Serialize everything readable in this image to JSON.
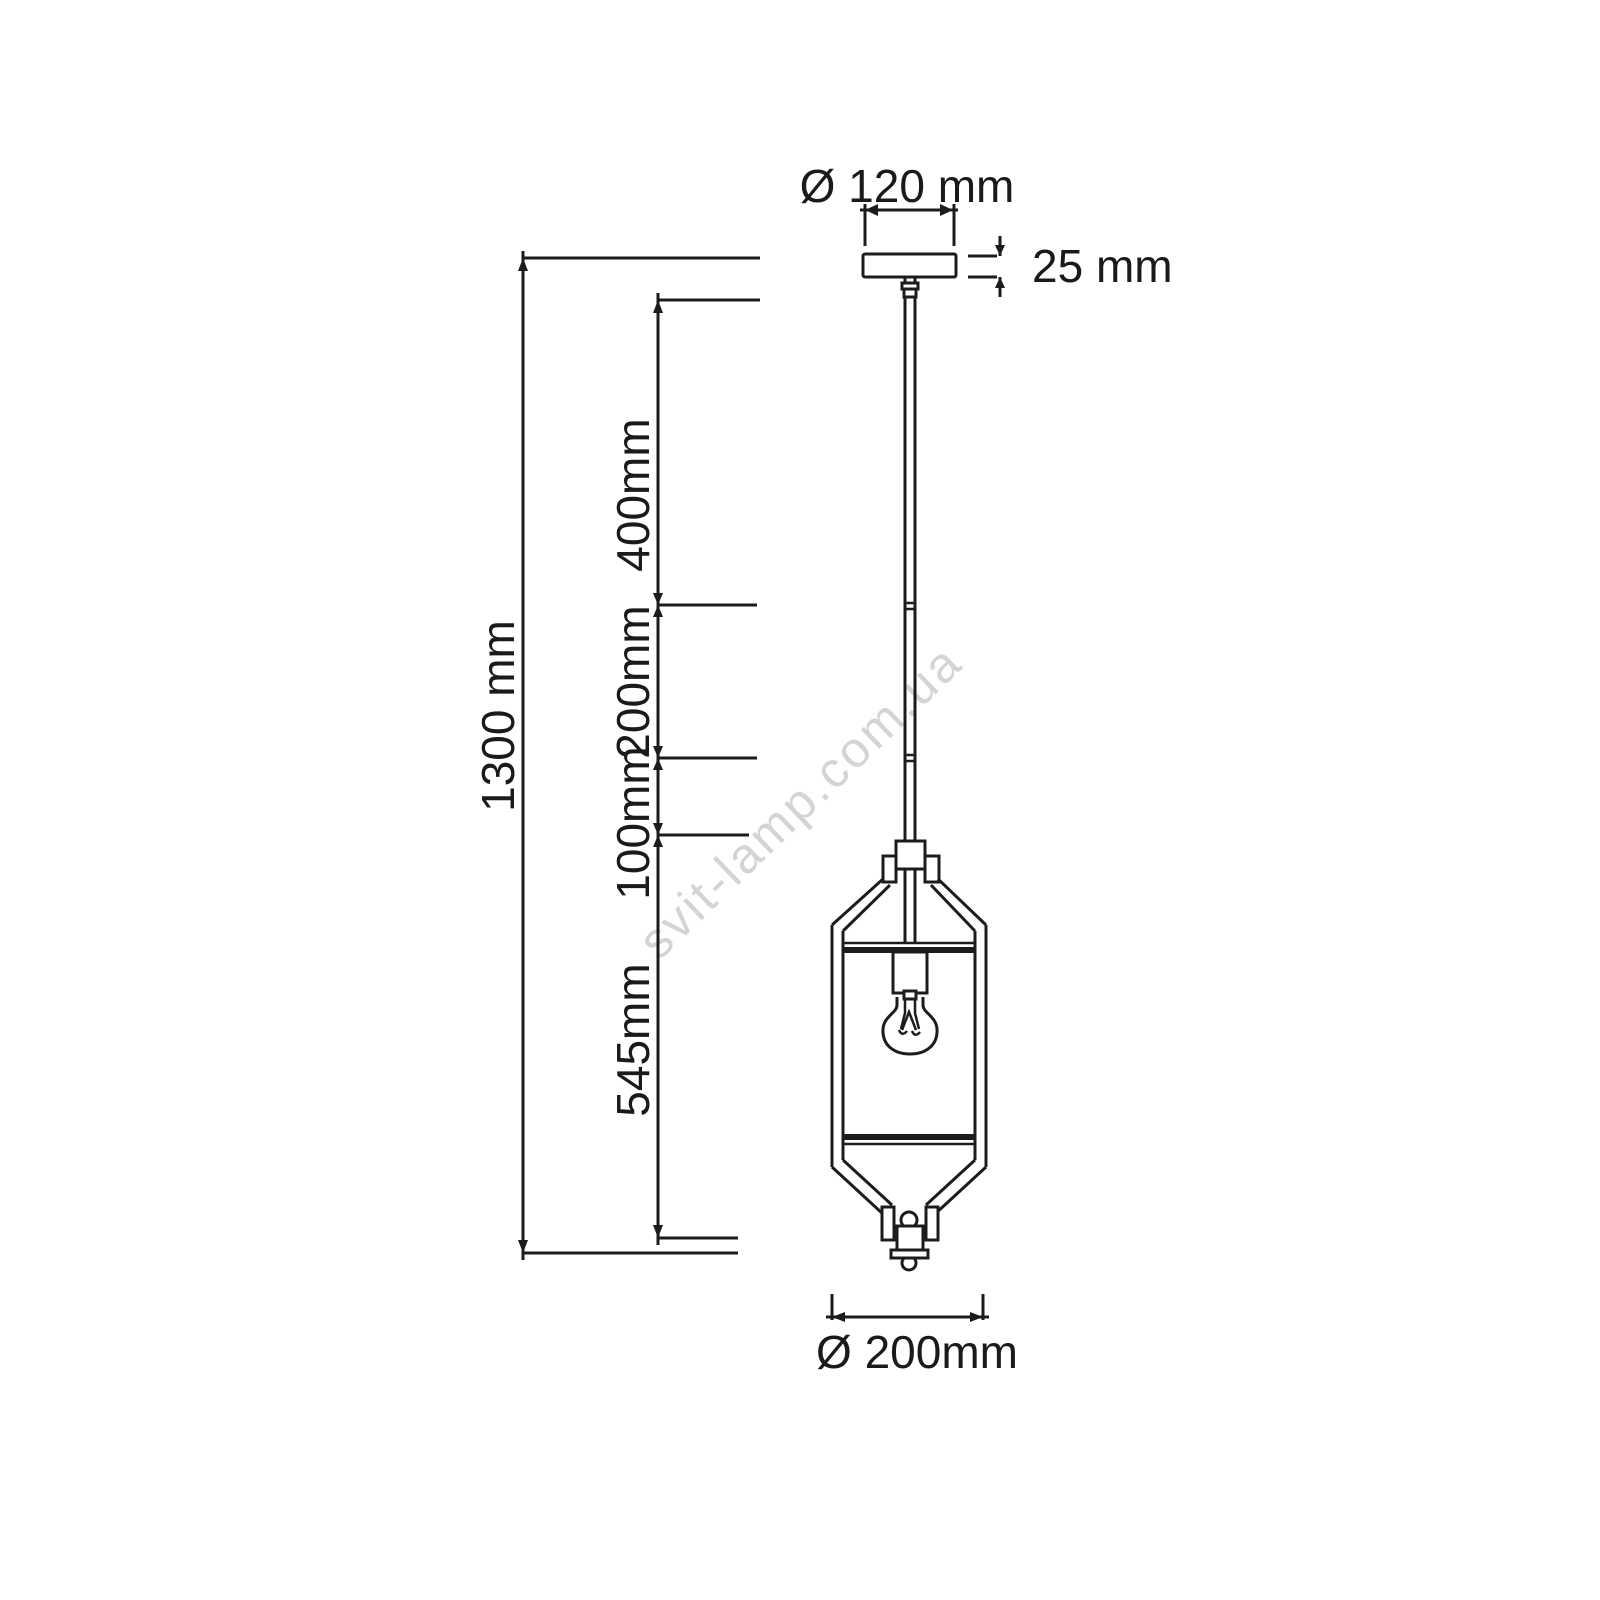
{
  "drawing": {
    "type": "technical-dimension-drawing",
    "subject": "pendant lantern lamp, front elevation",
    "background": "#ffffff",
    "line_color": "#1c1c1c",
    "text_color": "#1a1a1a",
    "watermark": {
      "text": "svit-lamp.com.ua",
      "color": "#d4d4d4"
    },
    "labels": {
      "canopy_diameter": "Ø 120 mm",
      "canopy_thickness": "25 mm",
      "total_height": "1300 mm",
      "rod_segment_top": "400mm",
      "rod_segment_middle": "200mm",
      "rod_segment_bottom": "100mm",
      "lantern_height": "545mm",
      "lantern_diameter": "Ø 200mm"
    }
  }
}
